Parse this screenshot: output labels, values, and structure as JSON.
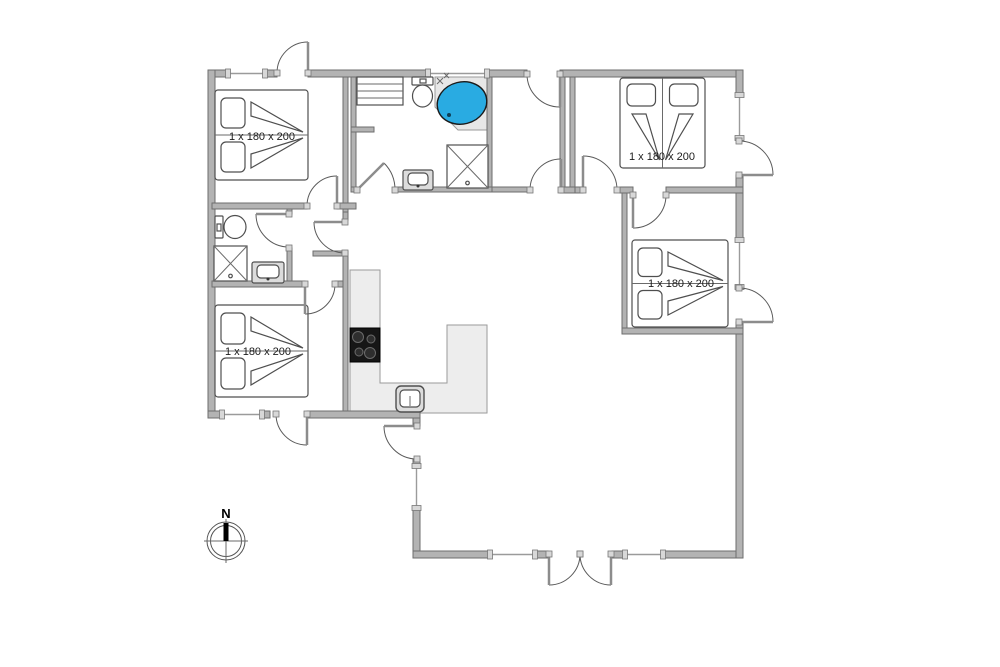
{
  "labels": {
    "bed_tl": "1 x 180 x 200",
    "bed_tr": "1 x 180 x 200",
    "bed_mr": "1 x 180 x 200",
    "bed_bl": "1 x 180 x 200",
    "compass_north": "N"
  },
  "colors": {
    "spa_blue": "#29ABE2",
    "wall_fill": "#b3b3b3",
    "wall_stroke": "#6e6e6e",
    "counter_fill": "#ededed",
    "counter_stroke": "#9a9a9a",
    "stove_black": "#161616",
    "line": "#4f4f4f"
  },
  "plan": {
    "walls": [
      {
        "n": "exterior-top-1",
        "x": 208,
        "y": 70,
        "w": 20,
        "h": 7
      },
      {
        "n": "exterior-top-2",
        "x": 265,
        "y": 70,
        "w": 12,
        "h": 7
      },
      {
        "n": "exterior-top-3",
        "x": 308,
        "y": 70,
        "w": 120,
        "h": 7
      },
      {
        "n": "exterior-top-4",
        "x": 487,
        "y": 70,
        "w": 40,
        "h": 7
      },
      {
        "n": "exterior-top-5",
        "x": 560,
        "y": 70,
        "w": 183,
        "h": 7
      },
      {
        "n": "exterior-left",
        "x": 208,
        "y": 70,
        "w": 7,
        "h": 348
      },
      {
        "n": "exterior-bottom-left-1",
        "x": 208,
        "y": 411,
        "w": 14,
        "h": 7
      },
      {
        "n": "exterior-bottom-left-2",
        "x": 262,
        "y": 411,
        "w": 8,
        "h": 7
      },
      {
        "n": "exterior-bottom-left-3",
        "x": 307,
        "y": 411,
        "w": 113,
        "h": 7
      },
      {
        "n": "exterior-west-living-1",
        "x": 413,
        "y": 418,
        "w": 7,
        "h": 8
      },
      {
        "n": "exterior-west-living-2",
        "x": 413,
        "y": 459,
        "w": 7,
        "h": 7
      },
      {
        "n": "exterior-west-living-3",
        "x": 413,
        "y": 508,
        "w": 7,
        "h": 50
      },
      {
        "n": "exterior-bottom-1",
        "x": 413,
        "y": 551,
        "w": 77,
        "h": 7
      },
      {
        "n": "exterior-bottom-2",
        "x": 535,
        "y": 551,
        "w": 13,
        "h": 7
      },
      {
        "n": "exterior-bottom-3",
        "x": 612,
        "y": 551,
        "w": 13,
        "h": 7
      },
      {
        "n": "exterior-bottom-4",
        "x": 663,
        "y": 551,
        "w": 80,
        "h": 7
      },
      {
        "n": "exterior-right-1",
        "x": 736,
        "y": 70,
        "w": 7,
        "h": 25
      },
      {
        "n": "exterior-right-2",
        "x": 736,
        "y": 175,
        "w": 7,
        "h": 65
      },
      {
        "n": "exterior-right-3",
        "x": 736,
        "y": 322,
        "w": 7,
        "h": 236
      },
      {
        "n": "bedroom-tl-east-wall",
        "x": 343,
        "y": 77,
        "w": 5,
        "h": 135
      },
      {
        "n": "bathroom-main-west-wall",
        "x": 351,
        "y": 77,
        "w": 5,
        "h": 110
      },
      {
        "n": "bathroom-main-stub",
        "x": 351,
        "y": 127,
        "w": 23,
        "h": 5
      },
      {
        "n": "bedroom-tl-south-wall-1",
        "x": 212,
        "y": 203,
        "w": 95,
        "h": 6
      },
      {
        "n": "bedroom-tl-south-wall-2",
        "x": 337,
        "y": 203,
        "w": 19,
        "h": 6
      },
      {
        "n": "bathroom-small-east-wall-1",
        "x": 287,
        "y": 209,
        "w": 5,
        "h": 5
      },
      {
        "n": "bathroom-small-east-wall-2",
        "x": 287,
        "y": 248,
        "w": 5,
        "h": 33
      },
      {
        "n": "bathroom-small-south-wall-1",
        "x": 212,
        "y": 281,
        "w": 93,
        "h": 6
      },
      {
        "n": "bathroom-small-south-wall-2",
        "x": 335,
        "y": 281,
        "w": 13,
        "h": 6
      },
      {
        "n": "hall-east-wall-1",
        "x": 343,
        "y": 212,
        "w": 5,
        "h": 8
      },
      {
        "n": "hall-east-wall-2",
        "x": 343,
        "y": 253,
        "w": 5,
        "h": 158
      },
      {
        "n": "hall-stub",
        "x": 313,
        "y": 251,
        "w": 35,
        "h": 5
      },
      {
        "n": "bathroom-main-south-1",
        "x": 351,
        "y": 187,
        "w": 6,
        "h": 5
      },
      {
        "n": "bathroom-main-south-2",
        "x": 395,
        "y": 187,
        "w": 97,
        "h": 5
      },
      {
        "n": "bathroom-main-east-wall",
        "x": 487,
        "y": 77,
        "w": 5,
        "h": 110
      },
      {
        "n": "entry-hall-south-wall",
        "x": 492,
        "y": 187,
        "w": 38,
        "h": 5
      },
      {
        "n": "entry-hall-east-wall-a",
        "x": 560,
        "y": 77,
        "w": 5,
        "h": 110
      },
      {
        "n": "bedroom-tr-west-wall",
        "x": 570,
        "y": 77,
        "w": 5,
        "h": 110
      },
      {
        "n": "entry-hall-south-closer",
        "x": 560,
        "y": 187,
        "w": 15,
        "h": 6
      },
      {
        "n": "bedroom-tr-south-wall-1",
        "x": 575,
        "y": 187,
        "w": 8,
        "h": 6
      },
      {
        "n": "bedroom-tr-south-wall-2",
        "x": 620,
        "y": 187,
        "w": 13,
        "h": 6
      },
      {
        "n": "bedroom-tr-south-wall-3",
        "x": 666,
        "y": 187,
        "w": 77,
        "h": 6
      },
      {
        "n": "bedroom-mr-west-wall",
        "x": 622,
        "y": 193,
        "w": 5,
        "h": 135
      },
      {
        "n": "bedroom-mr-south-wall",
        "x": 622,
        "y": 328,
        "w": 121,
        "h": 6
      }
    ],
    "windows": [
      {
        "n": "window-top-bedroom-tl",
        "x": 228,
        "y": 70,
        "w": 37,
        "h": 7
      },
      {
        "n": "window-top-bathroom",
        "x": 428,
        "y": 70,
        "w": 59,
        "h": 7
      },
      {
        "n": "window-bottom-bedroom-bl",
        "x": 222,
        "y": 411,
        "w": 40,
        "h": 7
      },
      {
        "n": "window-west-living",
        "x": 413,
        "y": 466,
        "w": 7,
        "h": 42
      },
      {
        "n": "window-bottom-living-1",
        "x": 490,
        "y": 551,
        "w": 45,
        "h": 7
      },
      {
        "n": "window-bottom-living-2",
        "x": 625,
        "y": 551,
        "w": 38,
        "h": 7
      },
      {
        "n": "window-right-bedroom-tr",
        "x": 736,
        "y": 95,
        "w": 7,
        "h": 43
      },
      {
        "n": "window-right-bedroom-mr",
        "x": 736,
        "y": 240,
        "w": 7,
        "h": 47
      }
    ],
    "doors": [
      {
        "n": "door-exterior-bedroom-tl",
        "arc": "M277,73 A31,31 0 0 1 308,42",
        "leaf": [
          308,
          73,
          308,
          42
        ],
        "jambs": [
          [
            308,
            73
          ],
          [
            277,
            73
          ]
        ]
      },
      {
        "n": "door-entrance-top",
        "arc": "M527,74 A33,33 0 0 0 560,107",
        "leaf": [
          560,
          74,
          560,
          107
        ],
        "jambs": [
          [
            560,
            74
          ],
          [
            527,
            74
          ]
        ]
      },
      {
        "n": "door-exterior-bedroom-bl",
        "arc": "M276,414 A31,31 0 0 0 307,445",
        "leaf": [
          307,
          414,
          307,
          445
        ],
        "jambs": [
          [
            307,
            414
          ],
          [
            276,
            414
          ]
        ]
      },
      {
        "n": "door-exterior-living-west",
        "arc": "M384,426 A33,33 0 0 0 417,459",
        "leaf": [
          417,
          426,
          384,
          426
        ],
        "jambs": [
          [
            417,
            426
          ],
          [
            417,
            459
          ]
        ]
      },
      {
        "n": "door-terrace-left",
        "arc": "M580,554 A31,31 0 0 1 549,585",
        "leaf": [
          549,
          554,
          549,
          585
        ],
        "jambs": [
          [
            549,
            554
          ],
          [
            580,
            554
          ]
        ]
      },
      {
        "n": "door-terrace-right",
        "arc": "M580,554 A31,31 0 0 0 611,585",
        "leaf": [
          611,
          554,
          611,
          585
        ],
        "jambs": [
          [
            611,
            554
          ],
          [
            580,
            554
          ]
        ]
      },
      {
        "n": "door-exterior-bedroom-tr",
        "arc": "M739,141 A34,34 0 0 1 773,175",
        "leaf": [
          739,
          175,
          773,
          175
        ],
        "jambs": [
          [
            739,
            175
          ],
          [
            739,
            141
          ]
        ]
      },
      {
        "n": "door-exterior-bedroom-mr",
        "arc": "M739,288 A34,34 0 0 1 773,322",
        "leaf": [
          739,
          322,
          773,
          322
        ],
        "jambs": [
          [
            739,
            322
          ],
          [
            739,
            288
          ]
        ]
      },
      {
        "n": "door-entry-hall-south",
        "arc": "M530,190 A31,31 0 0 1 561,159",
        "leaf": [
          561,
          190,
          561,
          159
        ],
        "jambs": [
          [
            561,
            190
          ],
          [
            530,
            190
          ]
        ]
      },
      {
        "n": "door-bedroom-tr",
        "arc": "M583,156 A34,34 0 0 1 617,190",
        "leaf": [
          583,
          190,
          583,
          156
        ],
        "jambs": [
          [
            583,
            190
          ],
          [
            617,
            190
          ]
        ]
      },
      {
        "n": "door-bedroom-mr",
        "arc": "M666,195 A33,33 0 0 1 633,228",
        "leaf": [
          633,
          195,
          633,
          228
        ],
        "jambs": [
          [
            633,
            195
          ],
          [
            666,
            195
          ]
        ]
      },
      {
        "n": "door-bathroom-small",
        "arc": "M256,214 A33,33 0 0 0 289,247",
        "leaf": [
          289,
          214,
          256,
          214
        ],
        "jambs": [
          [
            289,
            214
          ],
          [
            289,
            248
          ]
        ]
      },
      {
        "n": "door-hall-living",
        "arc": "M314,222 A31,31 0 0 0 345,253",
        "leaf": [
          345,
          222,
          314,
          222
        ],
        "jambs": [
          [
            345,
            222
          ],
          [
            345,
            253
          ]
        ]
      },
      {
        "n": "door-bedroom-tl",
        "arc": "M307,206 A30,30 0 0 1 337,176",
        "leaf": [
          337,
          206,
          337,
          176
        ],
        "jambs": [
          [
            337,
            206
          ],
          [
            307,
            206
          ]
        ]
      },
      {
        "n": "door-bedroom-bl",
        "arc": "M335,284 A30,30 0 0 1 305,314",
        "leaf": [
          305,
          284,
          305,
          314
        ],
        "jambs": [
          [
            305,
            284
          ],
          [
            335,
            284
          ]
        ]
      },
      {
        "n": "door-bathroom-main",
        "arc": "M395,190 A38,38 0 0 0 384,163",
        "leaf": [
          357,
          190,
          384,
          163
        ],
        "jambs": [
          [
            357,
            190
          ],
          [
            395,
            190
          ]
        ]
      }
    ],
    "beds": [
      {
        "n": "bed-bedroom-tl",
        "x": 215,
        "y": 90,
        "w": 93,
        "h": 90,
        "head": "w"
      },
      {
        "n": "bed-bedroom-tr",
        "x": 620,
        "y": 78,
        "w": 85,
        "h": 90,
        "head": "n"
      },
      {
        "n": "bed-bedroom-mr",
        "x": 632,
        "y": 240,
        "w": 96,
        "h": 87,
        "head": "w"
      },
      {
        "n": "bed-bedroom-bl",
        "x": 215,
        "y": 305,
        "w": 93,
        "h": 92,
        "head": "w"
      }
    ],
    "fixtures": [
      {
        "t": "wardrobe",
        "n": "shelf-unit",
        "x": 357,
        "y": 77,
        "w": 46,
        "h": 28
      },
      {
        "t": "toilet",
        "n": "toilet-small-bathroom",
        "orient": "e",
        "x": 215,
        "y": 216
      },
      {
        "t": "toilet",
        "n": "toilet-main-bathroom",
        "orient": "s",
        "x": 412,
        "y": 77
      },
      {
        "t": "shower",
        "n": "shower-small-bathroom",
        "x": 214,
        "y": 246,
        "w": 33,
        "h": 35
      },
      {
        "t": "shower",
        "n": "shower-main-bathroom",
        "x": 447,
        "y": 145,
        "w": 41,
        "h": 43
      },
      {
        "t": "sink",
        "n": "sink-small-bathroom",
        "x": 252,
        "y": 262,
        "w": 32,
        "h": 21
      },
      {
        "t": "sink",
        "n": "sink-main-bathroom",
        "x": 403,
        "y": 170,
        "w": 30,
        "h": 20
      }
    ],
    "spa": {
      "platform": "435,77 492,77 492,130 458,130 435,107",
      "cx": 462,
      "cy": 103,
      "rx": 25,
      "ry": 21,
      "rot": -14
    },
    "kitchen": {
      "counter": "M350,270 L380,270 L380,383 L447,383 L447,325 L487,325 L487,413 L350,413 Z",
      "stove": {
        "x": 350,
        "y": 328,
        "w": 30,
        "h": 34
      },
      "burners": [
        [
          358,
          337,
          5.5
        ],
        [
          371,
          339,
          4
        ],
        [
          359,
          352,
          4
        ],
        [
          370,
          353,
          5.5
        ]
      ],
      "sink": {
        "x": 396,
        "y": 386,
        "w": 28,
        "h": 26
      }
    },
    "compass": {
      "cx": 226,
      "cy": 541,
      "r_outer": 19,
      "r_inner": 15.5,
      "cross": 22,
      "needle_w": 5,
      "needle_h": 18
    }
  }
}
